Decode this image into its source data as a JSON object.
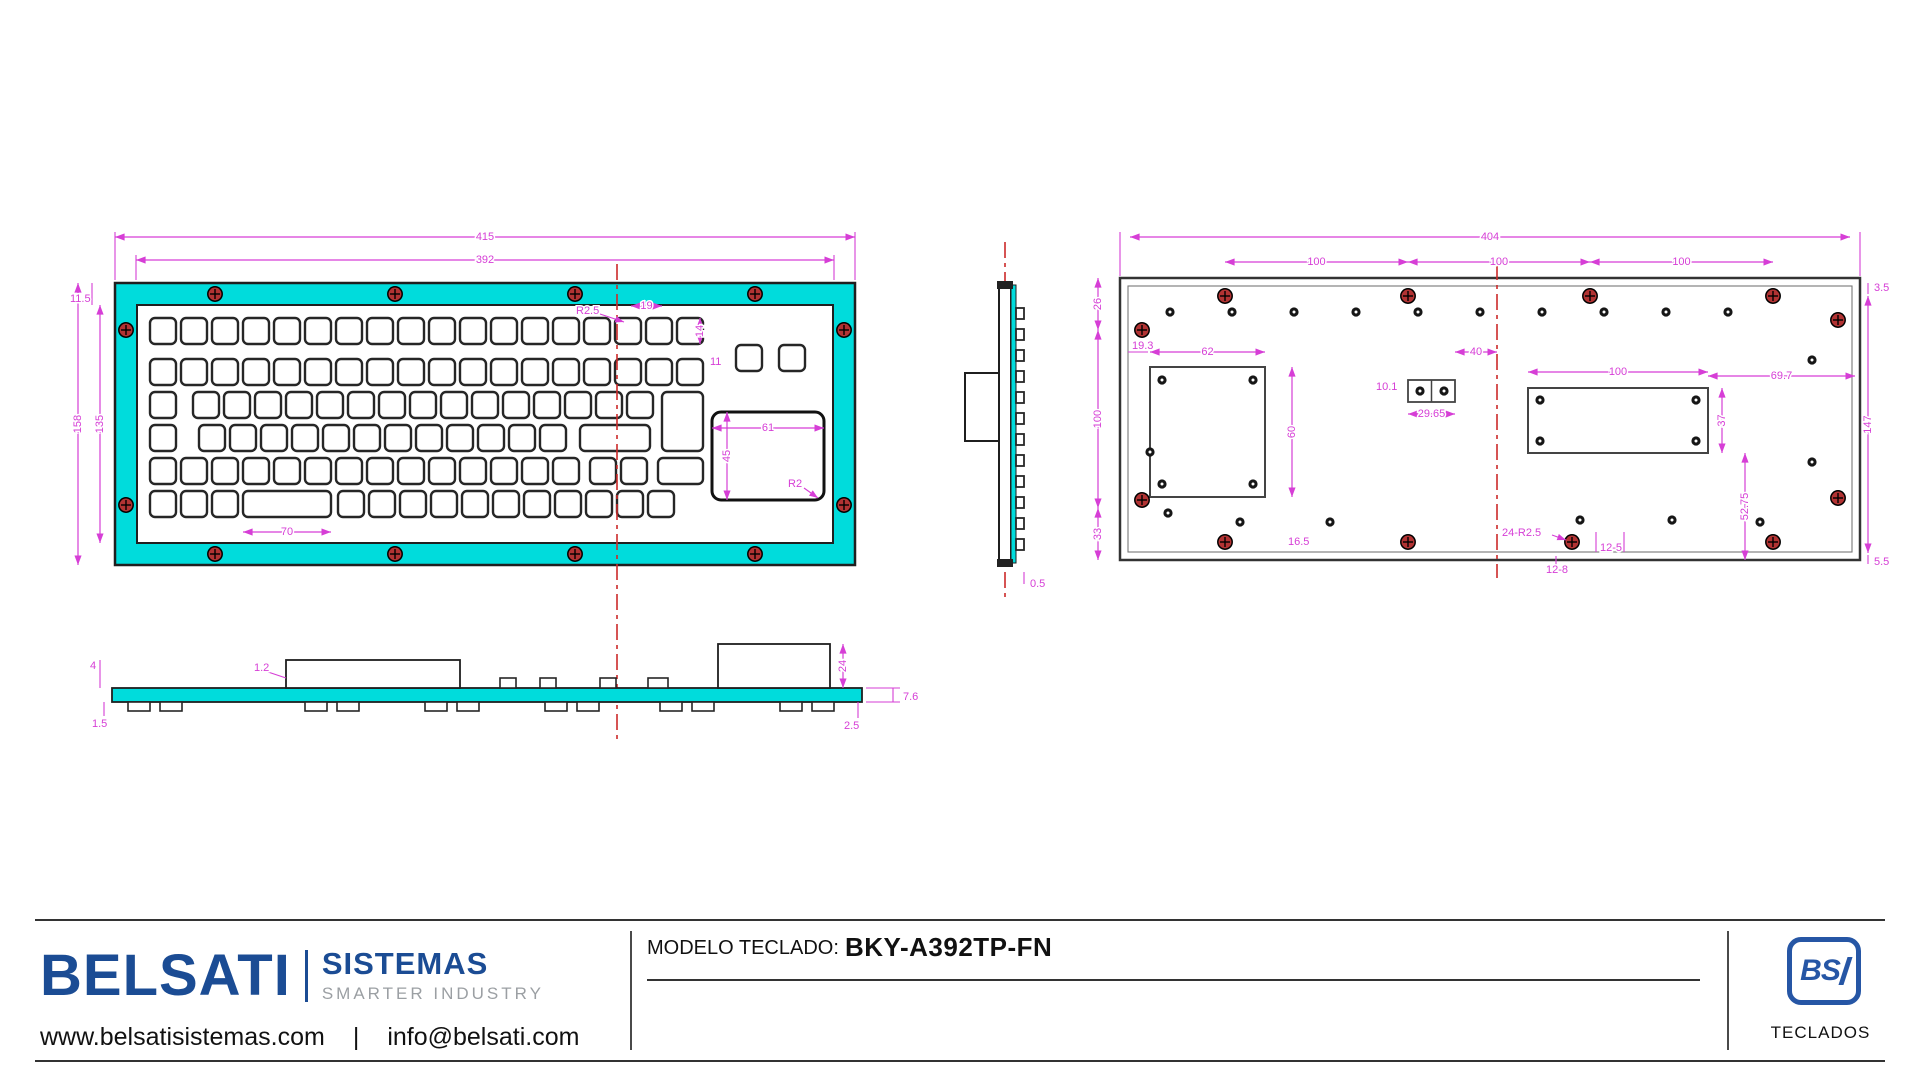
{
  "colors": {
    "teal": "#00dcdc",
    "dim": "#d63ed6",
    "red": "#cc2a2a",
    "screw": "#b23333",
    "line": "#1f1f1f",
    "blue": "#1b4c94",
    "gray": "#9b9fa3",
    "dot": "#161616"
  },
  "footer": {
    "brand": {
      "name": "BELSATI",
      "sub": "SISTEMAS",
      "tagline": "SMARTER INDUSTRY",
      "website": "www.belsatisistemas.com",
      "sep": "|",
      "email": "info@belsati.com"
    },
    "model": {
      "label": "MODELO TECLADO:",
      "value": "BKY-A392TP-FN"
    },
    "bsi": {
      "text": "BS",
      "caption": "TECLADOS"
    }
  },
  "drawing": {
    "front": {
      "frame": {
        "x": 115,
        "y": 283,
        "w": 740,
        "h": 282,
        "bw": 22
      },
      "centerline": {
        "x": 617,
        "y1": 264,
        "y2": 742
      },
      "screws": [
        [
          215,
          294
        ],
        [
          395,
          294
        ],
        [
          575,
          294
        ],
        [
          755,
          294
        ],
        [
          215,
          554
        ],
        [
          395,
          554
        ],
        [
          575,
          554
        ],
        [
          755,
          554
        ],
        [
          126,
          330
        ],
        [
          126,
          505
        ],
        [
          844,
          330
        ],
        [
          844,
          505
        ]
      ],
      "key_runs": [
        {
          "x": 150,
          "y": 318,
          "n": 18
        },
        {
          "x": 150,
          "y": 359,
          "n": 18
        },
        {
          "x": 150,
          "y": 392,
          "n": 1
        },
        {
          "x": 193,
          "y": 392,
          "n": 15
        },
        {
          "x": 662,
          "y": 392,
          "n": 1,
          "w": 41,
          "h": 59
        },
        {
          "x": 150,
          "y": 425,
          "n": 1
        },
        {
          "x": 199,
          "y": 425,
          "n": 12
        },
        {
          "x": 580,
          "y": 425,
          "n": 1,
          "w": 70
        },
        {
          "x": 150,
          "y": 458,
          "n": 14
        },
        {
          "x": 590,
          "y": 458,
          "n": 2
        },
        {
          "x": 658,
          "y": 458,
          "n": 1,
          "w": 45
        },
        {
          "x": 150,
          "y": 491,
          "n": 3
        },
        {
          "x": 243,
          "y": 491,
          "n": 1,
          "w": 88
        },
        {
          "x": 338,
          "y": 491,
          "n": 11
        },
        {
          "x": 736,
          "y": 345,
          "n": 1
        },
        {
          "x": 779,
          "y": 345,
          "n": 1
        }
      ],
      "touchpad": {
        "x": 712,
        "y": 412,
        "w": 112,
        "h": 88
      },
      "dims_h": [
        {
          "x1": 115,
          "x2": 855,
          "y": 237,
          "label": "415"
        },
        {
          "x1": 136,
          "x2": 834,
          "y": 260,
          "label": "392"
        },
        {
          "x1": 631,
          "x2": 662,
          "y": 306,
          "label": "19"
        },
        {
          "x1": 712,
          "x2": 824,
          "y": 428,
          "label": "61"
        },
        {
          "x1": 243,
          "x2": 331,
          "y": 532,
          "label": "70"
        }
      ],
      "dims_v": [
        {
          "x": 78,
          "y1": 283,
          "y2": 565,
          "label": "158"
        },
        {
          "x": 100,
          "y1": 305,
          "y2": 543,
          "label": "135"
        },
        {
          "x": 700,
          "y1": 318,
          "y2": 344,
          "label": "14"
        },
        {
          "x": 727,
          "y1": 412,
          "y2": 500,
          "label": "45"
        }
      ],
      "labels": [
        {
          "x": 70,
          "y": 299,
          "t": "11.5"
        },
        {
          "x": 576,
          "y": 311,
          "t": "R2.5"
        },
        {
          "x": 710,
          "y": 362,
          "t": "11"
        },
        {
          "x": 788,
          "y": 484,
          "t": "R2"
        }
      ],
      "leaders": [
        [
          600,
          314,
          624,
          322
        ],
        [
          804,
          488,
          818,
          498
        ]
      ],
      "lines": [
        [
          92,
          283,
          92,
          305
        ],
        [
          115,
          280,
          115,
          232
        ],
        [
          855,
          280,
          855,
          232
        ],
        [
          136,
          280,
          136,
          255
        ],
        [
          834,
          280,
          834,
          255
        ]
      ]
    },
    "side": {
      "bar": {
        "x": 999,
        "y": 285,
        "w": 12,
        "h": 278
      },
      "teal": {
        "x": 1011,
        "y": 285,
        "w": 5,
        "h": 278
      },
      "box": {
        "x": 965,
        "y": 373,
        "w": 34,
        "h": 68
      },
      "nubs": {
        "x": 1016,
        "w": 8,
        "h": 11,
        "y0": 308,
        "step": 21,
        "count": 12
      },
      "caps": [
        [
          997,
          281,
          16,
          8
        ],
        [
          997,
          559,
          16,
          8
        ]
      ],
      "centerline": {
        "x": 1005,
        "y1": 242,
        "y2": 600
      },
      "labels": [
        {
          "x": 1030,
          "y": 584,
          "t": "0.5"
        }
      ],
      "lines": [
        [
          1024,
          572,
          1024,
          584
        ]
      ]
    },
    "back": {
      "plate": {
        "x": 1120,
        "y": 278,
        "w": 740,
        "h": 282
      },
      "centerline": {
        "x": 1497,
        "y1": 264,
        "y2": 578
      },
      "screws": [
        [
          1225,
          296
        ],
        [
          1408,
          296
        ],
        [
          1590,
          296
        ],
        [
          1773,
          296
        ],
        [
          1225,
          542
        ],
        [
          1408,
          542
        ],
        [
          1572,
          542
        ],
        [
          1773,
          542
        ],
        [
          1142,
          330
        ],
        [
          1142,
          500
        ],
        [
          1838,
          320
        ],
        [
          1838,
          498
        ]
      ],
      "dots": [
        [
          1170,
          312
        ],
        [
          1232,
          312
        ],
        [
          1294,
          312
        ],
        [
          1356,
          312
        ],
        [
          1418,
          312
        ],
        [
          1480,
          312
        ],
        [
          1542,
          312
        ],
        [
          1604,
          312
        ],
        [
          1666,
          312
        ],
        [
          1728,
          312
        ],
        [
          1162,
          380
        ],
        [
          1253,
          380
        ],
        [
          1162,
          484
        ],
        [
          1253,
          484
        ],
        [
          1150,
          452
        ],
        [
          1168,
          513
        ],
        [
          1420,
          391
        ],
        [
          1444,
          391
        ],
        [
          1540,
          400
        ],
        [
          1696,
          400
        ],
        [
          1540,
          441
        ],
        [
          1696,
          441
        ],
        [
          1240,
          522
        ],
        [
          1330,
          522
        ],
        [
          1580,
          520
        ],
        [
          1672,
          520
        ],
        [
          1760,
          522
        ],
        [
          1812,
          360
        ],
        [
          1812,
          462
        ]
      ],
      "inner_box": {
        "x": 1150,
        "y": 367,
        "w": 115,
        "h": 130
      },
      "connector": {
        "x": 1408,
        "y": 380,
        "w": 47,
        "h": 22
      },
      "cutout": {
        "x": 1528,
        "y": 388,
        "w": 180,
        "h": 65
      },
      "dims_h": [
        {
          "x1": 1130,
          "x2": 1850,
          "y": 237,
          "label": "404"
        },
        {
          "x1": 1225,
          "x2": 1408,
          "y": 262,
          "label": "100"
        },
        {
          "x1": 1408,
          "x2": 1590,
          "y": 262,
          "label": "100"
        },
        {
          "x1": 1590,
          "x2": 1773,
          "y": 262,
          "label": "100"
        },
        {
          "x1": 1150,
          "x2": 1265,
          "y": 352,
          "label": "62"
        },
        {
          "x1": 1455,
          "x2": 1497,
          "y": 352,
          "label": "40"
        },
        {
          "x1": 1528,
          "x2": 1708,
          "y": 372,
          "label": "100"
        },
        {
          "x1": 1708,
          "x2": 1855,
          "y": 376,
          "label": "69.7"
        },
        {
          "x1": 1408,
          "x2": 1455,
          "y": 414,
          "label": "29.65"
        }
      ],
      "dims_v": [
        {
          "x": 1098,
          "y1": 278,
          "y2": 330,
          "label": "26"
        },
        {
          "x": 1098,
          "y1": 330,
          "y2": 508,
          "label": "100"
        },
        {
          "x": 1098,
          "y1": 508,
          "y2": 560,
          "label": "33"
        },
        {
          "x": 1292,
          "y1": 367,
          "y2": 497,
          "label": "60"
        },
        {
          "x": 1722,
          "y1": 388,
          "y2": 453,
          "label": "37"
        },
        {
          "x": 1745,
          "y1": 453,
          "y2": 560,
          "label": "52.75"
        },
        {
          "x": 1868,
          "y1": 296,
          "y2": 553,
          "label": "147"
        }
      ],
      "labels": [
        {
          "x": 1874,
          "y": 288,
          "t": "3.5"
        },
        {
          "x": 1874,
          "y": 562,
          "t": "5.5"
        },
        {
          "x": 1132,
          "y": 346,
          "t": "19.3"
        },
        {
          "x": 1376,
          "y": 387,
          "t": "10.1"
        },
        {
          "x": 1288,
          "y": 542,
          "t": "16.5"
        },
        {
          "x": 1502,
          "y": 533,
          "t": "24-R2.5"
        },
        {
          "x": 1600,
          "y": 548,
          "t": "12-5"
        },
        {
          "x": 1546,
          "y": 570,
          "t": "12-8"
        }
      ],
      "leaders": [
        [
          1552,
          535,
          1566,
          540
        ]
      ],
      "lines": [
        [
          1868,
          283,
          1868,
          294
        ],
        [
          1868,
          555,
          1868,
          564
        ],
        [
          1128,
          352,
          1148,
          352
        ],
        [
          1596,
          532,
          1596,
          552
        ],
        [
          1624,
          532,
          1624,
          552
        ],
        [
          1556,
          556,
          1556,
          568
        ],
        [
          1120,
          276,
          1120,
          232
        ],
        [
          1860,
          276,
          1860,
          232
        ]
      ]
    },
    "bottom": {
      "bar": {
        "x": 112,
        "y": 688,
        "w": 750,
        "h": 14
      },
      "boxes": [
        {
          "x": 286,
          "y": 660,
          "w": 174,
          "h": 28
        },
        {
          "x": 718,
          "y": 644,
          "w": 112,
          "h": 44
        }
      ],
      "bumps": [
        [
          500,
          678,
          16,
          10
        ],
        [
          540,
          678,
          16,
          10
        ],
        [
          600,
          678,
          16,
          10
        ],
        [
          648,
          678,
          20,
          10
        ]
      ],
      "feet_y": 702,
      "feet_w": 22,
      "feet_h": 9,
      "feet_x": [
        128,
        160,
        305,
        337,
        425,
        457,
        545,
        577,
        660,
        692,
        780,
        812
      ],
      "dims_v": [
        {
          "x": 843,
          "y1": 644,
          "y2": 688,
          "label": "24"
        }
      ],
      "labels": [
        {
          "x": 90,
          "y": 666,
          "t": "4"
        },
        {
          "x": 92,
          "y": 724,
          "t": "1.5"
        },
        {
          "x": 254,
          "y": 668,
          "t": "1.2"
        },
        {
          "x": 903,
          "y": 697,
          "t": "7.6"
        },
        {
          "x": 844,
          "y": 726,
          "t": "2.5"
        }
      ],
      "lines": [
        [
          100,
          660,
          100,
          688
        ],
        [
          104,
          702,
          104,
          716
        ],
        [
          858,
          702,
          858,
          718
        ],
        [
          866,
          688,
          900,
          688
        ],
        [
          866,
          702,
          900,
          702
        ],
        [
          893,
          688,
          893,
          702
        ],
        [
          268,
          672,
          286,
          678
        ]
      ]
    }
  }
}
